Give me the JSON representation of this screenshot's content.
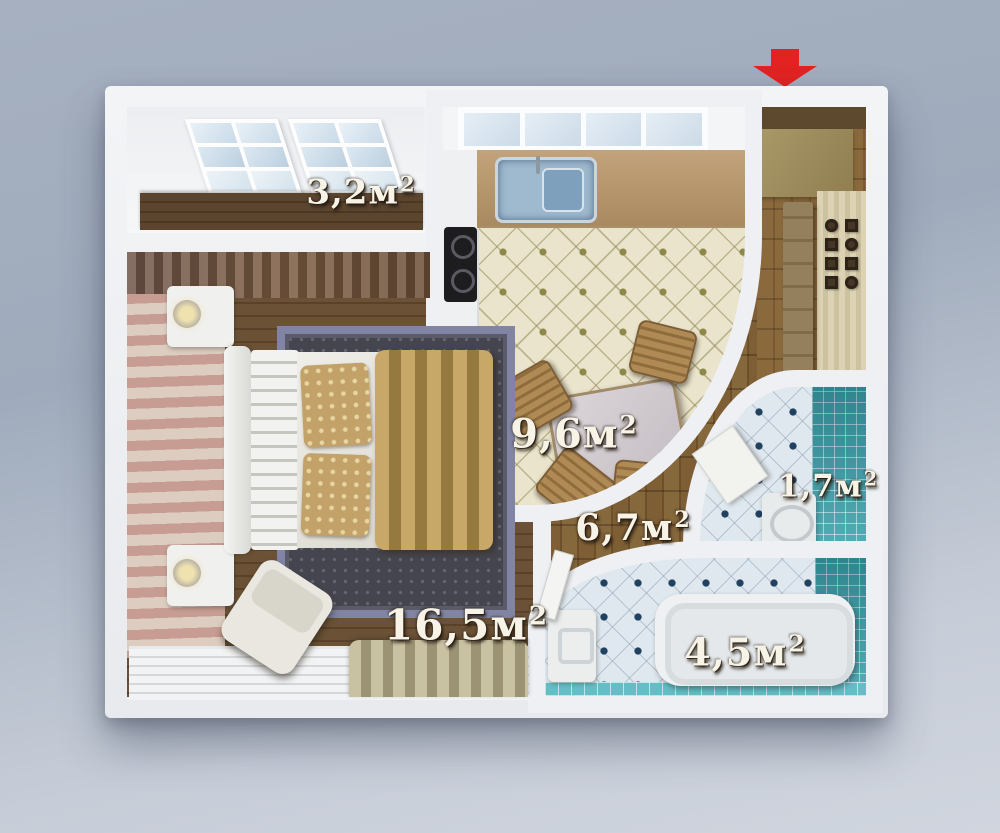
{
  "plan": {
    "entrance_marker": {
      "shape": "arrow-down",
      "color": "#e32222"
    },
    "rooms": {
      "balcony": {
        "area": "3,2",
        "unit": "м",
        "sup": "2"
      },
      "kitchen": {
        "area": "9,6",
        "unit": "м",
        "sup": "2"
      },
      "hallway": {
        "area": "6,7",
        "unit": "м",
        "sup": "2"
      },
      "bedroom": {
        "area": "16,5",
        "unit": "м",
        "sup": "2"
      },
      "bathroom": {
        "area": "4,5",
        "unit": "м",
        "sup": "2"
      },
      "toilet": {
        "area": "1,7",
        "unit": "м",
        "sup": "2"
      }
    },
    "palette": {
      "background_top": "#a6b0c0",
      "background_bottom": "#d0d5de",
      "wall_white": "#eef0f3",
      "bedroom_wood": "#5a422a",
      "hall_parquet": "#6d4f2a",
      "kitchen_tile": "#eae4cc",
      "bath_tile": "#dfe8ee",
      "teal_tile": "#3fa3ad",
      "wallpaper_stripe": "#c79c92",
      "arrow_red": "#e32222",
      "label_text": "#f7f3e6"
    }
  }
}
